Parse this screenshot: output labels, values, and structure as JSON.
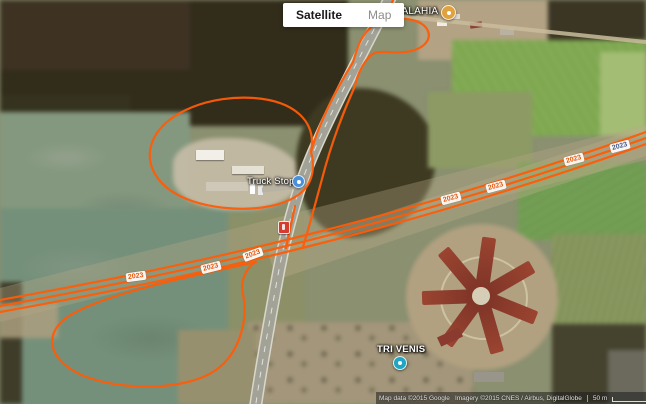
{
  "map_control": {
    "satellite_label": "Satellite",
    "map_label": "Map"
  },
  "pois": {
    "restaurant": {
      "name": "Restaurantul ALAHIA",
      "icon": "restaurant-poi-icon",
      "color": "#e0a23e"
    },
    "truck_stop": {
      "name": "Truck Stop",
      "icon": "blue-poi-icon",
      "color": "#4a90d9"
    },
    "tri_venis": {
      "name": "TRI VENIS",
      "icon": "teal-poi-icon",
      "color": "#20a5c2"
    }
  },
  "track_labels": [
    {
      "text": "2023"
    },
    {
      "text": "2023"
    },
    {
      "text": "2023"
    },
    {
      "text": "2023"
    },
    {
      "text": "2023"
    },
    {
      "text": "2023"
    },
    {
      "text": "2023"
    }
  ],
  "attribution": {
    "map_data": "Map data ©2015 Google",
    "imagery": "Imagery ©2015 CNES / Airbus, DigitalGlobe",
    "scale": "50 m",
    "terms": "Terms of Use",
    "report": "Report a map error"
  },
  "colors": {
    "gps_track_orange": "#ff5c07",
    "track_label_orange": "#e8570a",
    "track_label_blue": "#44598c",
    "road_shield_red": "#d63b2f"
  }
}
